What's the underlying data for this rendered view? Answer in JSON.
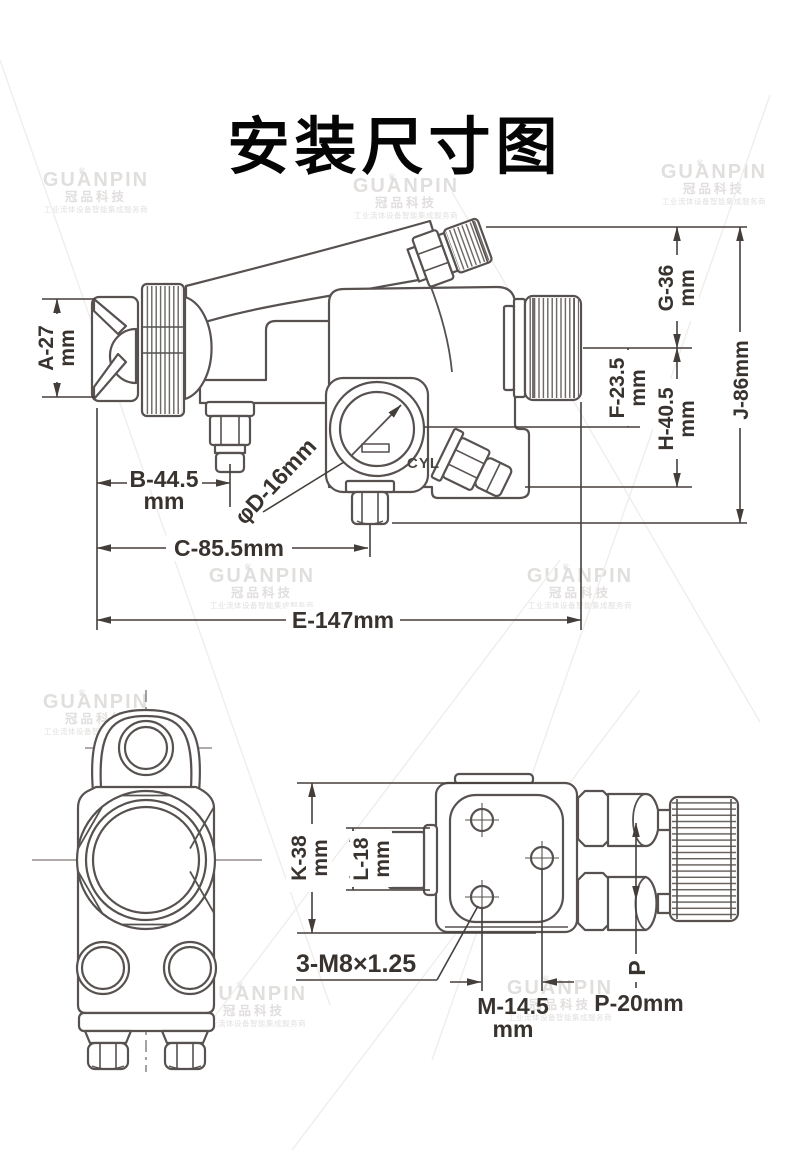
{
  "title": "安装尺寸图",
  "watermark": {
    "brand": "GUANPIN",
    "crown": "♛",
    "brand_cn": "冠品科技",
    "tagline": "工业流体设备智能集成服务商"
  },
  "side_view": {
    "cyl_label": "CYL",
    "dims": {
      "A": {
        "value": "A-27",
        "unit": "mm"
      },
      "B": {
        "value": "B-44.5",
        "unit": "mm"
      },
      "C": {
        "value": "C-85.5mm"
      },
      "D": {
        "value": "φD-16mm"
      },
      "E": {
        "value": "E-147mm"
      },
      "F": {
        "value": "F-23.5",
        "unit": "mm"
      },
      "G": {
        "value": "G-36",
        "unit": "mm"
      },
      "H": {
        "value": "H-40.5",
        "unit": "mm"
      },
      "J": {
        "value": "J-86mm"
      }
    }
  },
  "rear_view": {
    "dims": {
      "K": {
        "value": "K-38",
        "unit": "mm"
      },
      "L": {
        "value": "L-18",
        "unit": "mm"
      },
      "M": {
        "value": "M-14.5",
        "unit": "mm"
      },
      "P_axis": {
        "value": "P"
      },
      "P": {
        "value": "P-20mm"
      },
      "thread": {
        "value": "3-M8×1.25"
      }
    }
  }
}
